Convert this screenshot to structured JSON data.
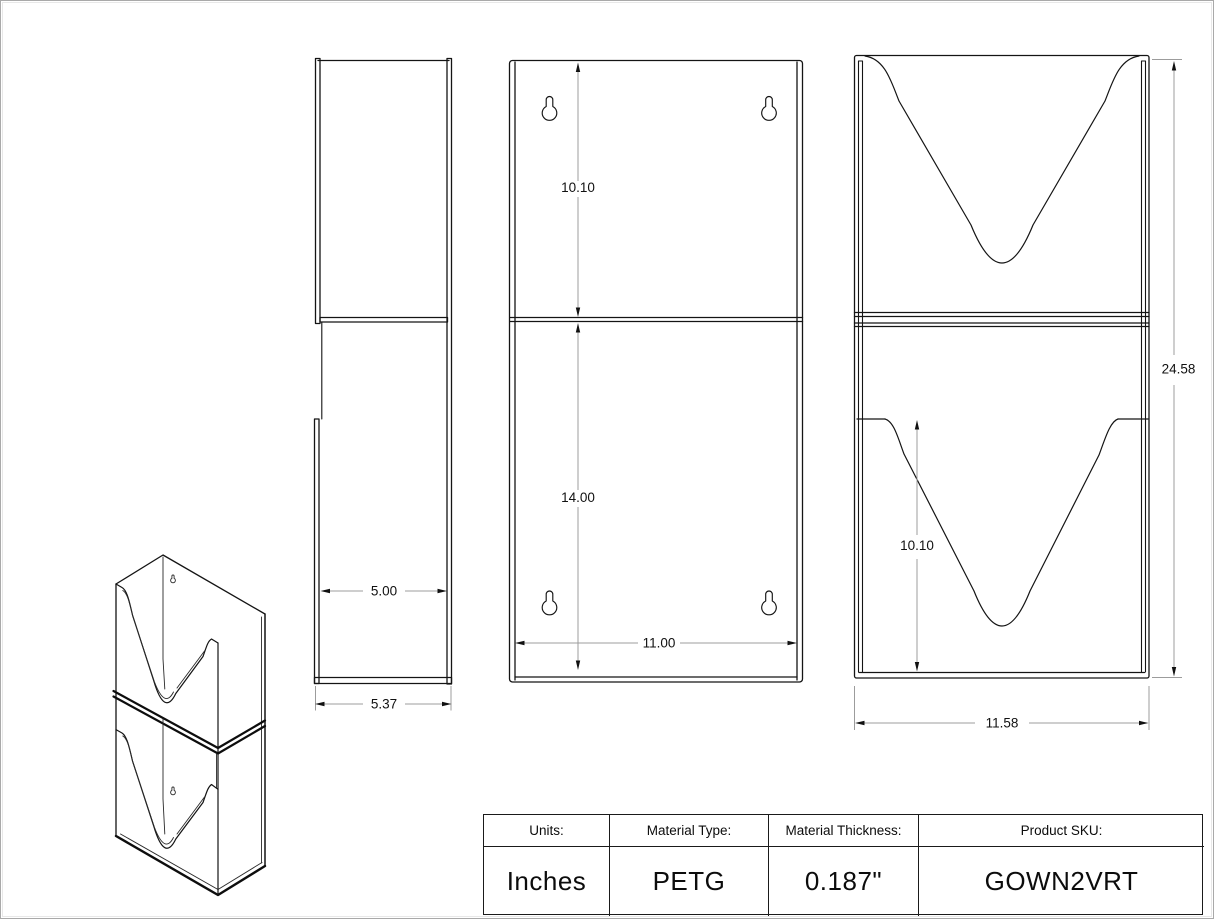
{
  "drawing": {
    "product": "GOWN2VRT",
    "views": {
      "back_panel": {
        "upper_height": "10.10",
        "lower_height": "14.00",
        "inner_width": "11.00"
      },
      "side": {
        "inner_depth": "5.00",
        "outer_depth": "5.37"
      },
      "front": {
        "pocket_height": "10.10",
        "overall_height": "24.58",
        "overall_width": "11.58"
      }
    }
  },
  "title_block": {
    "columns": [
      {
        "label": "Units:",
        "value": "Inches"
      },
      {
        "label": "Material Type:",
        "value": "PETG"
      },
      {
        "label": "Material Thickness:",
        "value": "0.187\""
      },
      {
        "label": "Product SKU:",
        "value": "GOWN2VRT"
      }
    ]
  }
}
